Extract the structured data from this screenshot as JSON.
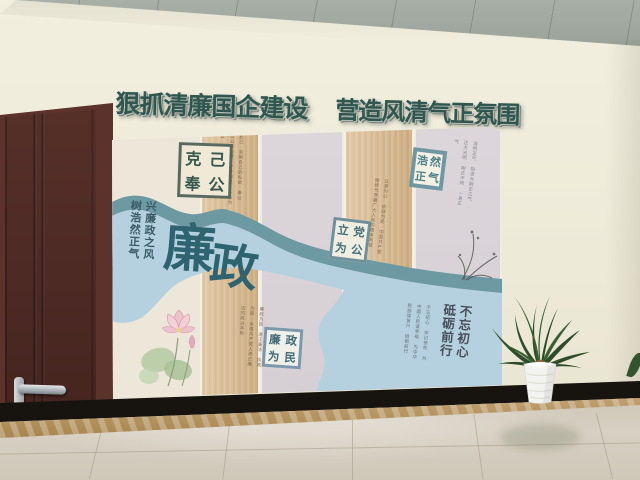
{
  "banner": {
    "left": "狠抓清廉国企建设",
    "right": "营造风清气正氛围"
  },
  "mural": {
    "main_title_chars": [
      "廉",
      "政"
    ],
    "left_slogan": "兴廉政之风\n树浩然正气",
    "bottom_right_slogan": "不忘初心\n砥砺前行",
    "cards": [
      {
        "id": "keji-fenggong",
        "chars": [
          "克",
          "己",
          "奉",
          "公"
        ]
      },
      {
        "id": "haoran-zhengqi",
        "chars": [
          "浩",
          "然",
          "正",
          "气"
        ]
      },
      {
        "id": "lidang-weigong",
        "chars": [
          "立",
          "党",
          "为",
          "公"
        ]
      },
      {
        "id": "lianzheng-weimin",
        "chars": [
          "廉",
          "政",
          "为",
          "民"
        ]
      }
    ],
    "notes": {
      "keji": "克己 克制自己的私欲 奉公 以公事为重 严于律己 一心为公",
      "haoran": "浩然正气 指浩大刚正之气 正大光明 刚正不阿 一身正气",
      "lidang": "立党为公 执政为民 中国共产党始终代表最广大人民的根本利益",
      "lianzheng": "廉政为民 清正廉洁 执政为民 永葆共产党人清正廉洁的政治本色",
      "buwang": "不忘初心 牢记使命 为中国人民谋幸福 为中华民族谋复兴 砥砺前行"
    }
  },
  "colors": {
    "banner_text": "#2f5750",
    "river_dark_teal": "#6d99a3",
    "river_light_blue": "#b5d0de",
    "wood_panel": "#d8b78b",
    "lavender_panel": "#d9d3d7",
    "wall_cream": "#eeead8",
    "door_brown": "#4e2a25",
    "ceiling_grey": "#9fa79f"
  }
}
